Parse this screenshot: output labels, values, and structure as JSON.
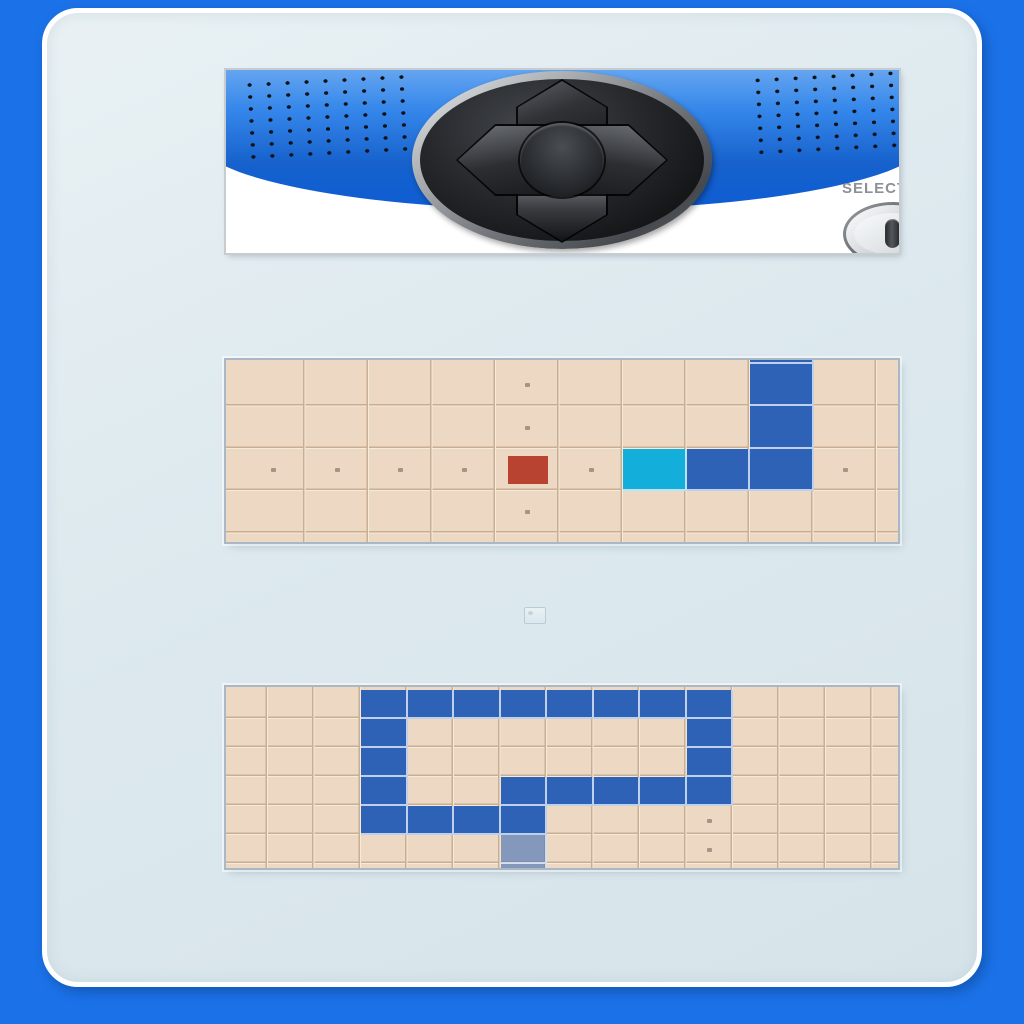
{
  "controller": {
    "select_label": "SELECT",
    "dpad_buttons": [
      "up",
      "down",
      "left",
      "right",
      "center"
    ]
  },
  "colors": {
    "frame_blue": "#1b72e8",
    "banner_blue": "#2f84ea",
    "board_bg": "#edd9c3",
    "grid_line_dark": "#c9ae93",
    "grid_line_light": "#f5ebd9",
    "snake_body": "#2d62b6",
    "snake_head": "#14aeda",
    "snake_tail_faded": "rgba(45,98,182,0.55)",
    "food": "#b94331",
    "guide_dot": "#a59585"
  },
  "boards": {
    "middle": {
      "grid": {
        "offset_x": 16,
        "cell_w": 63.5,
        "offset_y": 4,
        "cell_h": 42.4
      },
      "food": [
        [
          4,
          2
        ]
      ],
      "head": [
        [
          6,
          2
        ]
      ],
      "body": [
        [
          7,
          2
        ],
        [
          8,
          2
        ],
        [
          8,
          1
        ],
        [
          8,
          0
        ],
        [
          8,
          -1
        ]
      ],
      "tail": [],
      "dots": [
        [
          0,
          2
        ],
        [
          1,
          2
        ],
        [
          2,
          2
        ],
        [
          3,
          2
        ],
        [
          5,
          2
        ],
        [
          9,
          2
        ],
        [
          4,
          0
        ],
        [
          4,
          1
        ],
        [
          4,
          3
        ]
      ]
    },
    "bottom": {
      "grid": {
        "offset_x": -4.5,
        "cell_w": 46.5,
        "offset_y": 3,
        "cell_h": 29
      },
      "food": [],
      "head": [],
      "body": [
        [
          6,
          4
        ],
        [
          5,
          4
        ],
        [
          4,
          4
        ],
        [
          3,
          4
        ],
        [
          3,
          3
        ],
        [
          3,
          2
        ],
        [
          3,
          1
        ],
        [
          3,
          0
        ],
        [
          4,
          0
        ],
        [
          5,
          0
        ],
        [
          6,
          0
        ],
        [
          7,
          0
        ],
        [
          8,
          0
        ],
        [
          9,
          0
        ],
        [
          10,
          0
        ],
        [
          10,
          1
        ],
        [
          10,
          2
        ],
        [
          10,
          3
        ],
        [
          9,
          3
        ],
        [
          8,
          3
        ],
        [
          7,
          3
        ],
        [
          6,
          3
        ]
      ],
      "tail": [
        [
          6,
          5
        ],
        [
          6,
          6
        ]
      ],
      "dots": [
        [
          10,
          4
        ],
        [
          10,
          5
        ]
      ]
    }
  }
}
